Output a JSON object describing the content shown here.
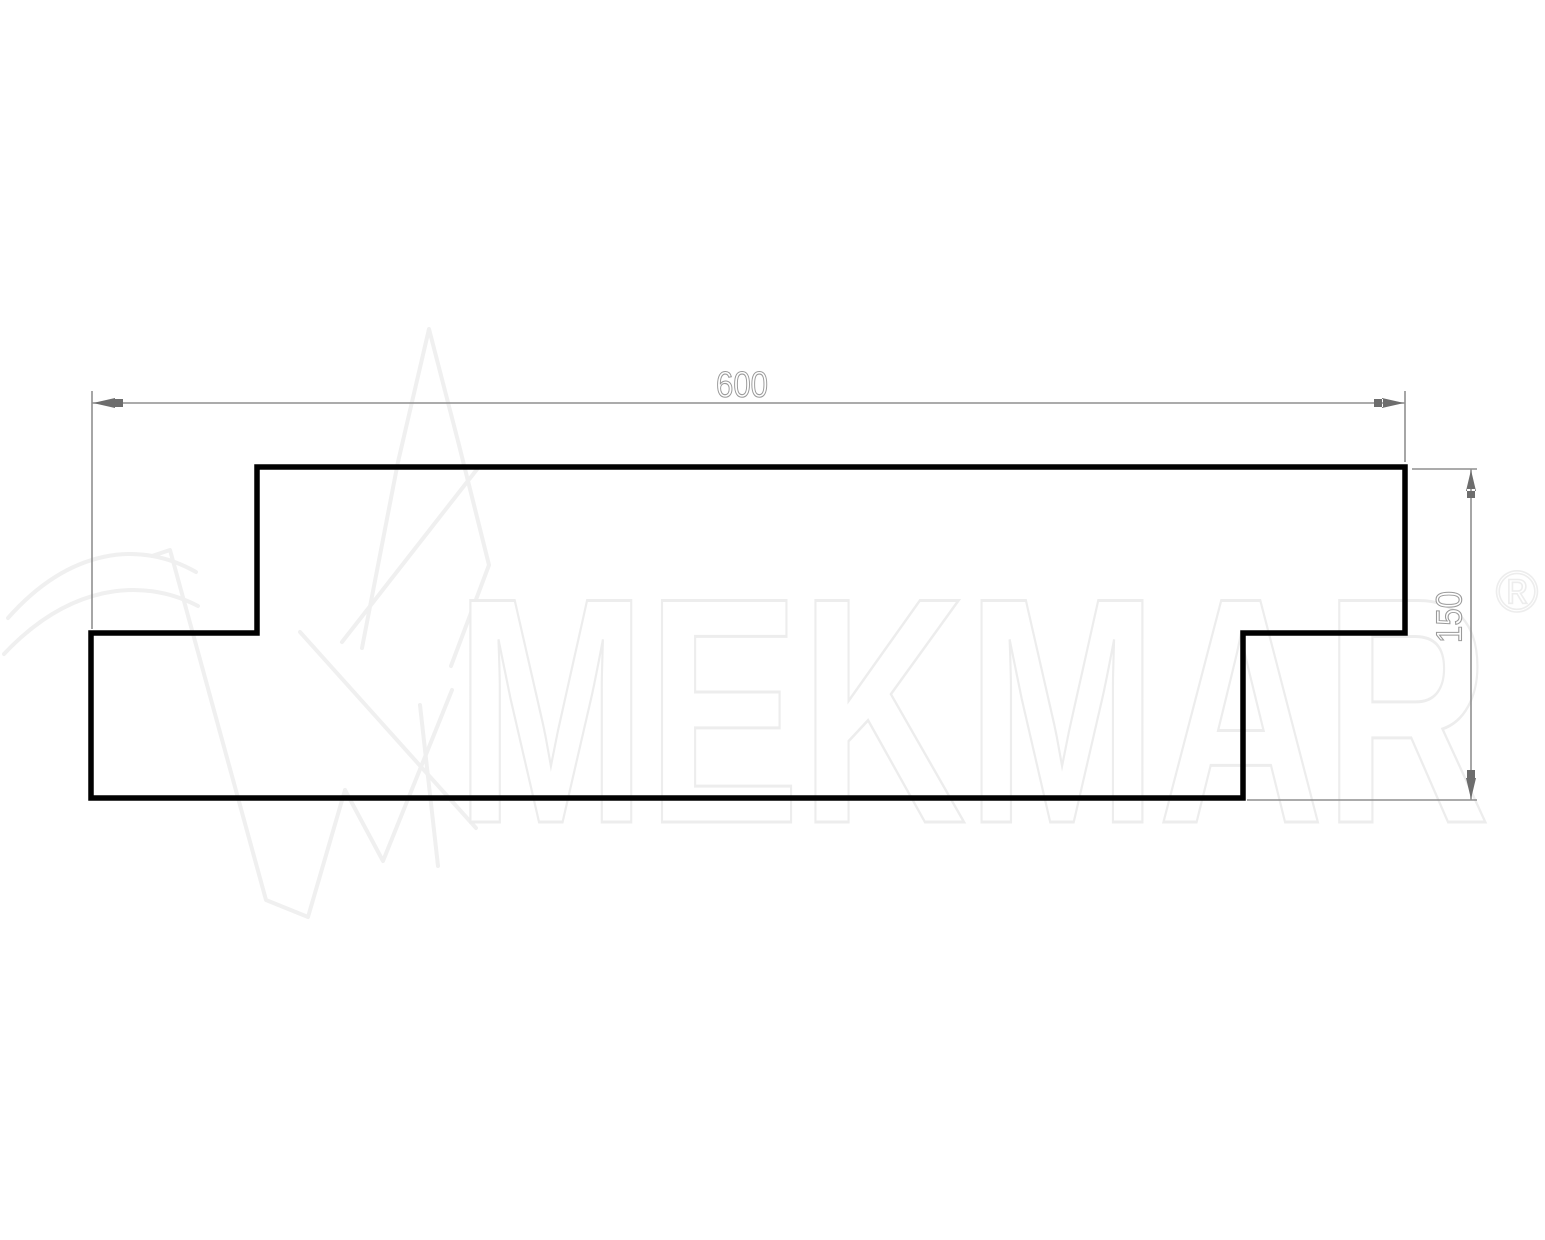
{
  "drawing": {
    "dimensions": {
      "width": {
        "value": "600"
      },
      "height": {
        "value": "150"
      }
    }
  },
  "watermark": {
    "brand": "MEKMAR",
    "registered": "®"
  },
  "colors": {
    "background": "#ffffff",
    "profile_outline": "#010101",
    "dimension_line": "#8f8f8f",
    "dimension_arrow": "#6d6d6d",
    "dimension_text": "#9a9a9a",
    "watermark_text": "#ededed",
    "watermark_logo": "#f0f0f0"
  }
}
